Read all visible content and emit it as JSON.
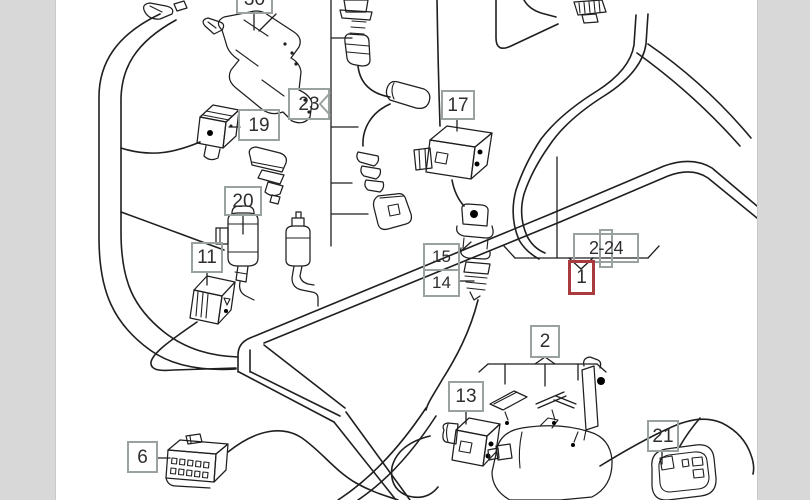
{
  "colors": {
    "line": "#1f1f1f",
    "callout-border": "#9aa1a1",
    "highlight-border": "#a93b3e",
    "sidebar": "#d8d8d8",
    "text": "#2e2e2e",
    "bg": "#ffffff"
  },
  "callouts": {
    "c30": "30",
    "c19": "19",
    "c23": "23",
    "c17": "17",
    "c20": "20",
    "c11": "11",
    "c15": "15",
    "c14": "14",
    "c2_24": "2-24",
    "c1": "1",
    "c2": "2",
    "c13": "13",
    "c6": "6",
    "c21": "21"
  }
}
